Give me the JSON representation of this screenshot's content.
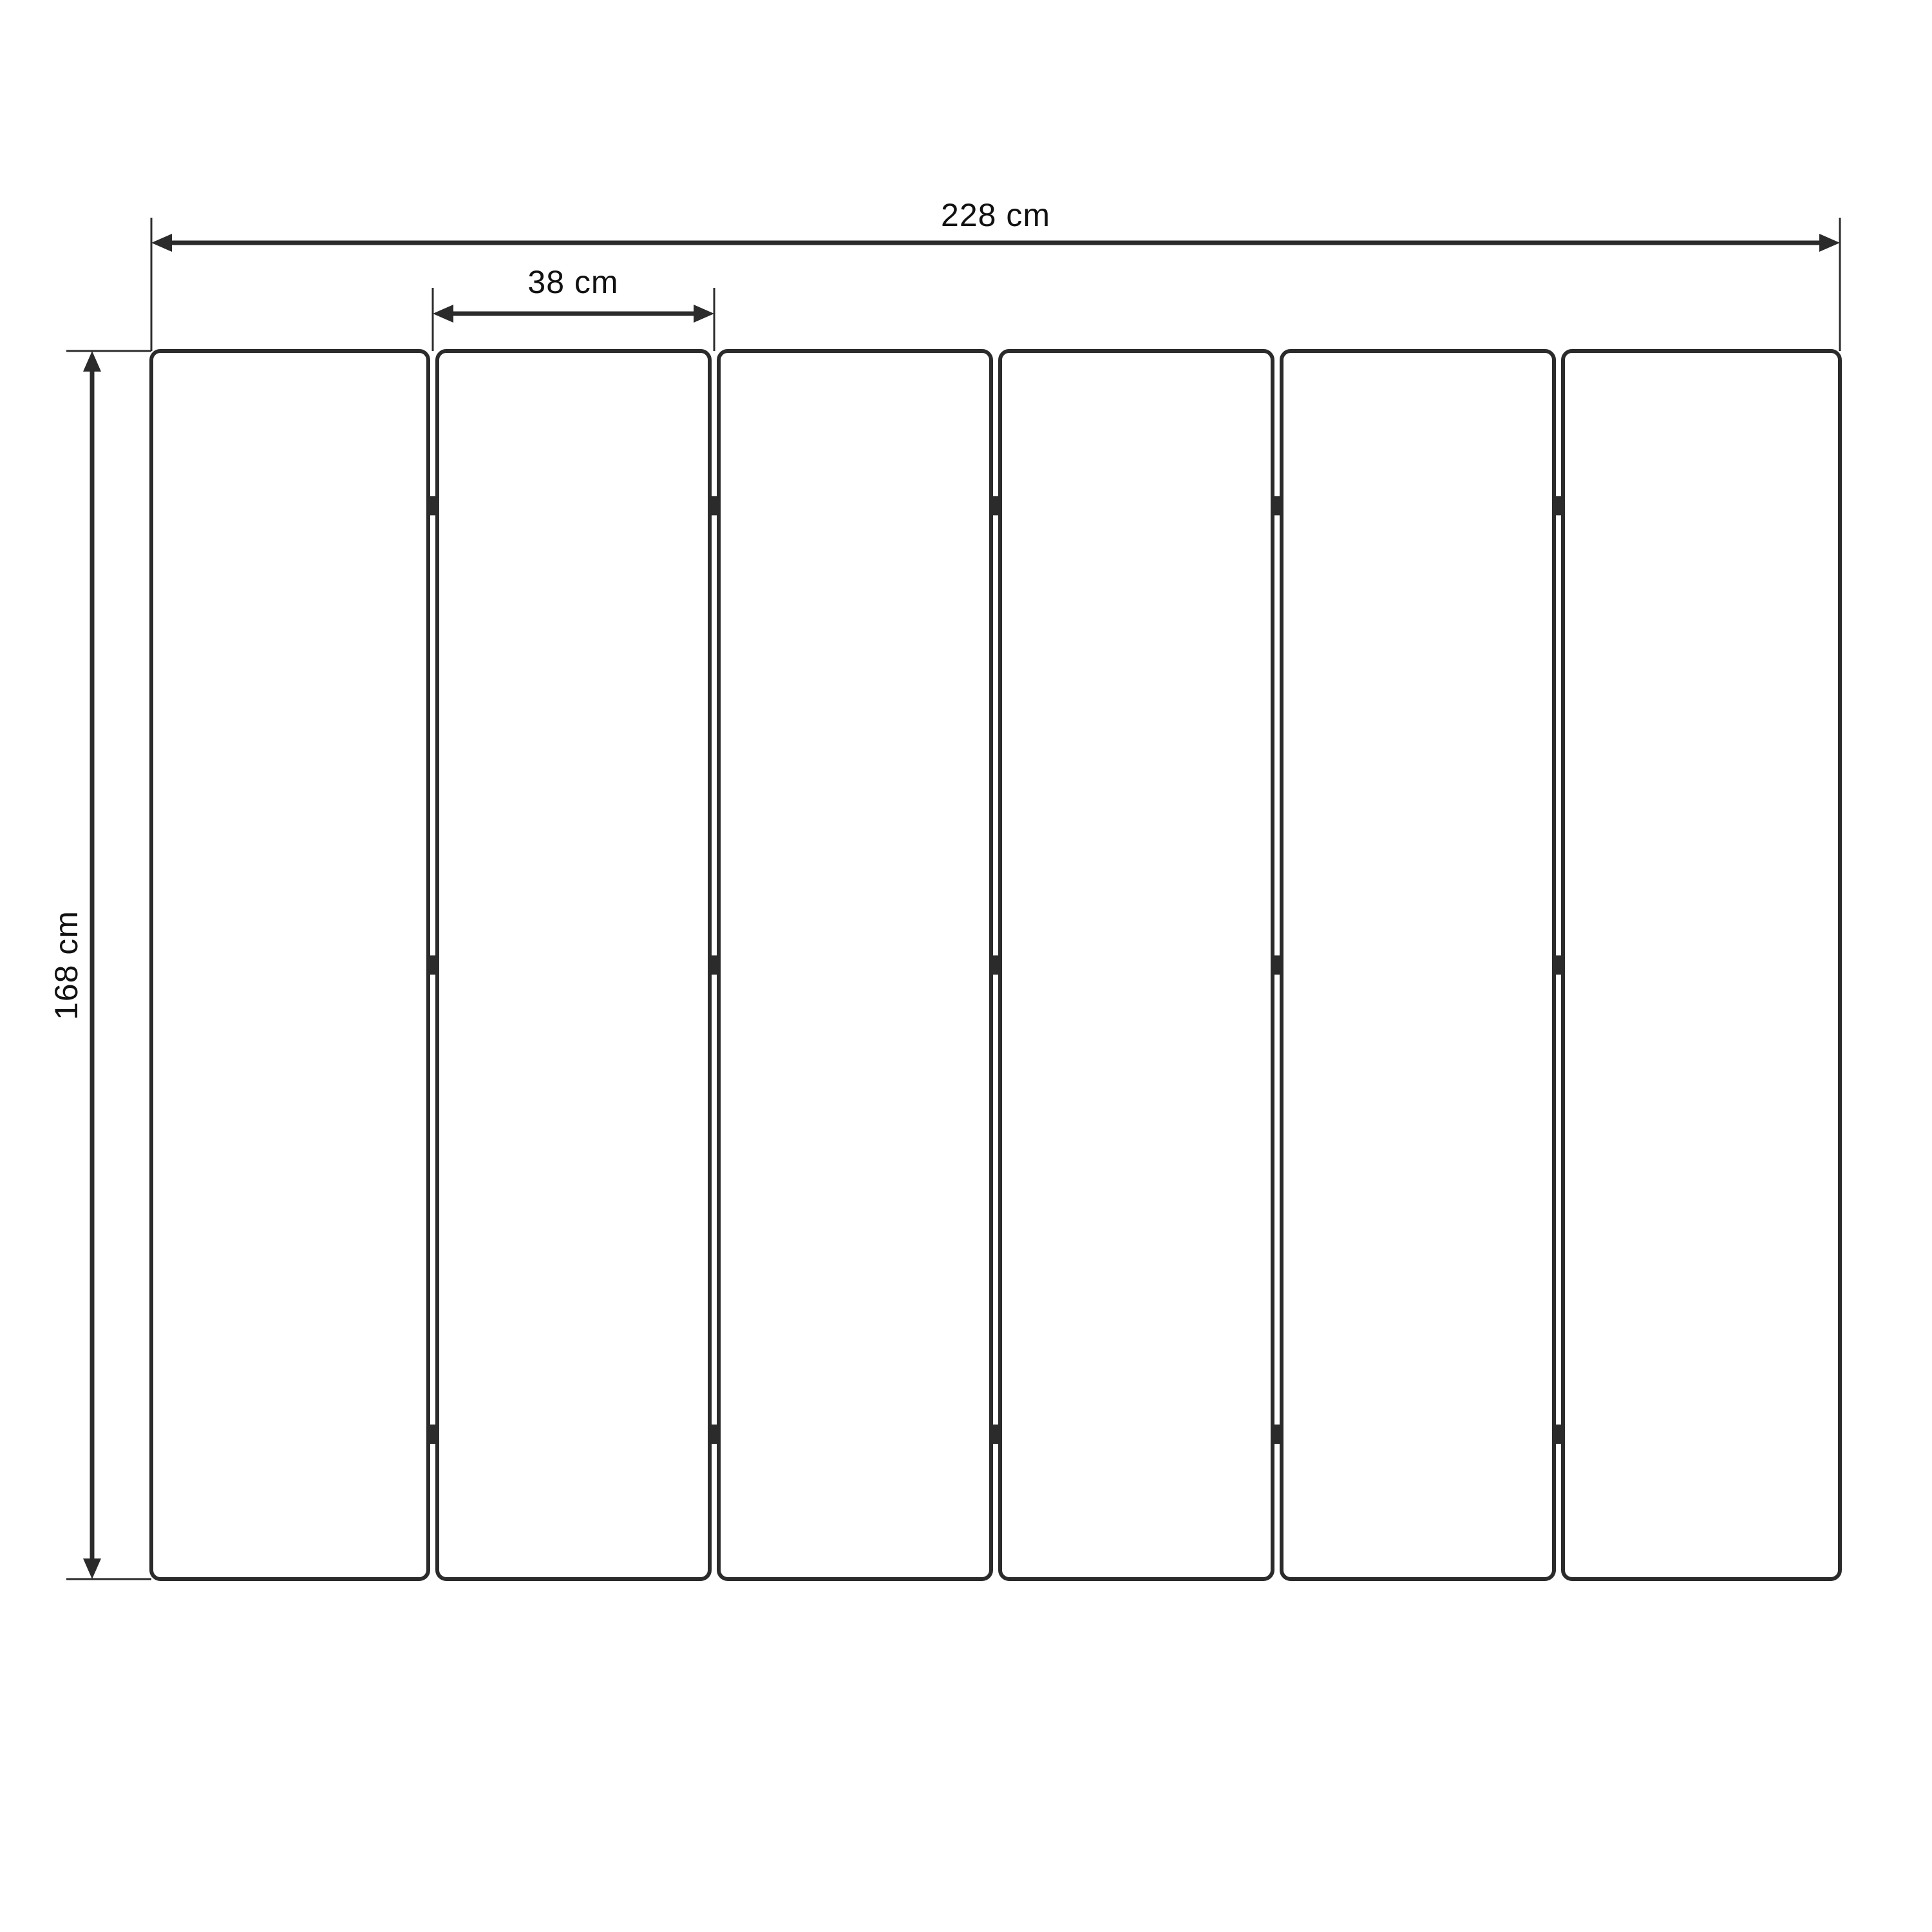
{
  "figure": {
    "background": "#ffffff",
    "stroke_color": "#2b2b2b",
    "text_color": "#111111",
    "unit": "cm",
    "dimensions": {
      "total_width": {
        "value": 228,
        "label": "228 cm"
      },
      "panel_width": {
        "value": 38,
        "label": "38 cm"
      },
      "height": {
        "value": 168,
        "label": "168 cm"
      }
    },
    "panels": {
      "count": 6,
      "hinge_joints": 5,
      "hinges_per_joint": 3,
      "hinge_positions_pct": [
        12.6,
        50,
        88.2
      ]
    }
  }
}
